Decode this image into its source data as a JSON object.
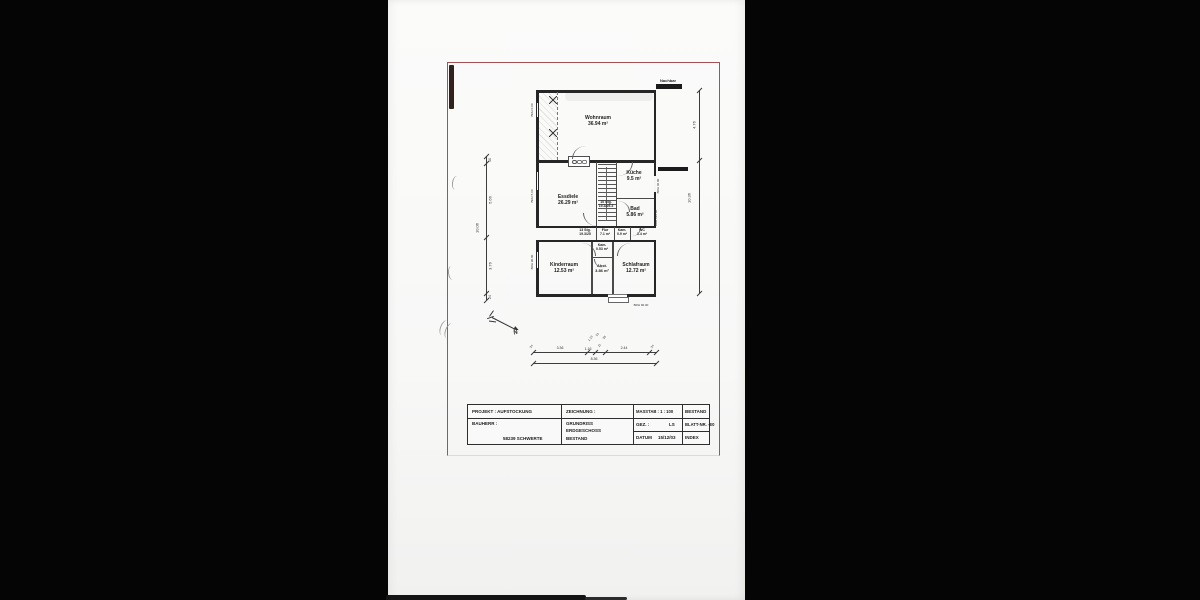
{
  "plan": {
    "neighbor_top": "Nachbar",
    "rooms": {
      "wohnraum": {
        "name": "Wohnraum",
        "area": "36.94 m²"
      },
      "essdiele": {
        "name": "Essdiele",
        "area": "26.29 m²"
      },
      "kueche": {
        "name": "Küche",
        "area": "9.5 m²"
      },
      "bad": {
        "name": "Bad",
        "area": "5.86 m²"
      },
      "flur": {
        "name": "Flur",
        "area": "7.1 m²"
      },
      "kam_flur": {
        "name": "Kam.",
        "area": "0.9 m²"
      },
      "wc": {
        "name": "WC",
        "area": "1.4 m²"
      },
      "kinderraum": {
        "name": "Kinderraum",
        "area": "12.53 m²"
      },
      "kam": {
        "name": "Kam.",
        "area": "0.53 m²"
      },
      "abst": {
        "name": "Abst.",
        "area": "3.86 m²"
      },
      "schlafraum": {
        "name": "Schlafraum",
        "area": "12.72 m²"
      }
    },
    "stairs": {
      "upper": {
        "line1": "10 Stg.",
        "line2": "19.3/25.3"
      },
      "lower": {
        "line1": "13 Stg.",
        "line2": "19.3/25"
      }
    },
    "brh": {
      "left_top": "BRH 0.00",
      "left_mid": "BRH 5.00",
      "left_bottom": "BRH 90.00",
      "right_top": "BRH 40.00",
      "right_mid": "BRH 126.00",
      "bottom": "BRH 90.00"
    },
    "north_label": "N",
    "dims": {
      "left": {
        "segments": [
          "40",
          "5.66",
          "3.76",
          "24"
        ],
        "overall": "10.06"
      },
      "right": {
        "upper": "4.76",
        "overall": "10.36"
      },
      "bottom": {
        "segments": [
          "24",
          "3.36",
          "1.16",
          "11",
          "2.44",
          "24"
        ],
        "overall": "8.36",
        "stack": [
          "1.13",
          "51",
          "38"
        ]
      }
    }
  },
  "title_block": {
    "projekt_label": "PROJEKT : AUFSTOCKUNG",
    "bauherr_label": "BAUHERR :",
    "bauherr_city": "58239 SCHWERTE",
    "zeichnung_label": "ZEICHNUNG :",
    "zeichnung_lines": [
      "GRUNDRISS",
      "ERDGESCHOSS",
      "BESTAND"
    ],
    "masstab": "MASSTAB : 1 : 100",
    "bestand": "BESTAND",
    "gez_label": "GEZ. :",
    "gez_value": "LS",
    "blatt": "BLATT-NR. -E0",
    "datum_label": "DATUM",
    "datum_value": "15/12/03",
    "index": "INDEX"
  }
}
